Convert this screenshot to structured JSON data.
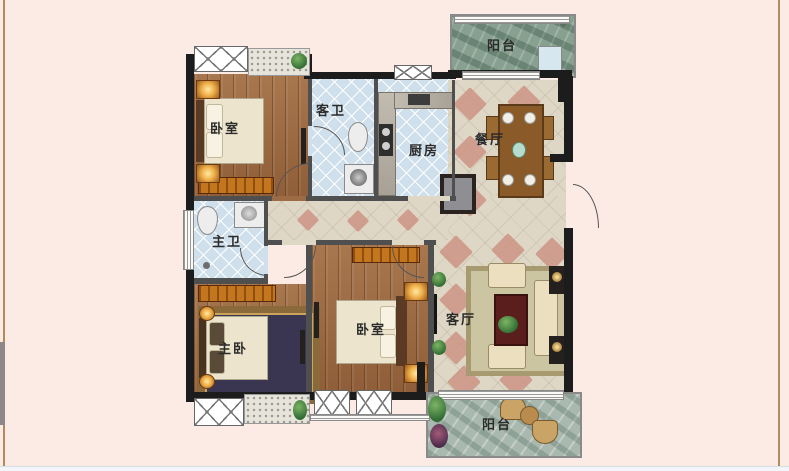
{
  "page": {
    "background": "#fcebe5",
    "side_border_color": "#b18b5e",
    "bottom_strip_color": "#f2f5f9",
    "scroll_fragment_color": "#8d8789"
  },
  "floorplan": {
    "rooms": [
      {
        "name": "bedroom-top",
        "label": "卧室"
      },
      {
        "name": "guest-bathroom",
        "label": "客卫"
      },
      {
        "name": "kitchen",
        "label": "厨房"
      },
      {
        "name": "dining-room",
        "label": "餐厅"
      },
      {
        "name": "balcony-top",
        "label": "阳台"
      },
      {
        "name": "master-bathroom",
        "label": "主卫"
      },
      {
        "name": "master-bedroom",
        "label": "主卧"
      },
      {
        "name": "bedroom-middle",
        "label": "卧室"
      },
      {
        "name": "living-room",
        "label": "客厅"
      },
      {
        "name": "balcony-bottom",
        "label": "阳台"
      }
    ],
    "palette": {
      "wall": "#1c1c1c",
      "wood_floor": "#9c6b44",
      "blue_tile": "#cfdfeb",
      "marble": "#ded7c5",
      "pink_diamond": "#cc9484",
      "slate_green": "#87a08f",
      "slate_light": "#aab9af",
      "furniture_orange": "#c4761f",
      "bed_cream": "#ece4cc",
      "label_color": "#2b2b2b"
    }
  }
}
